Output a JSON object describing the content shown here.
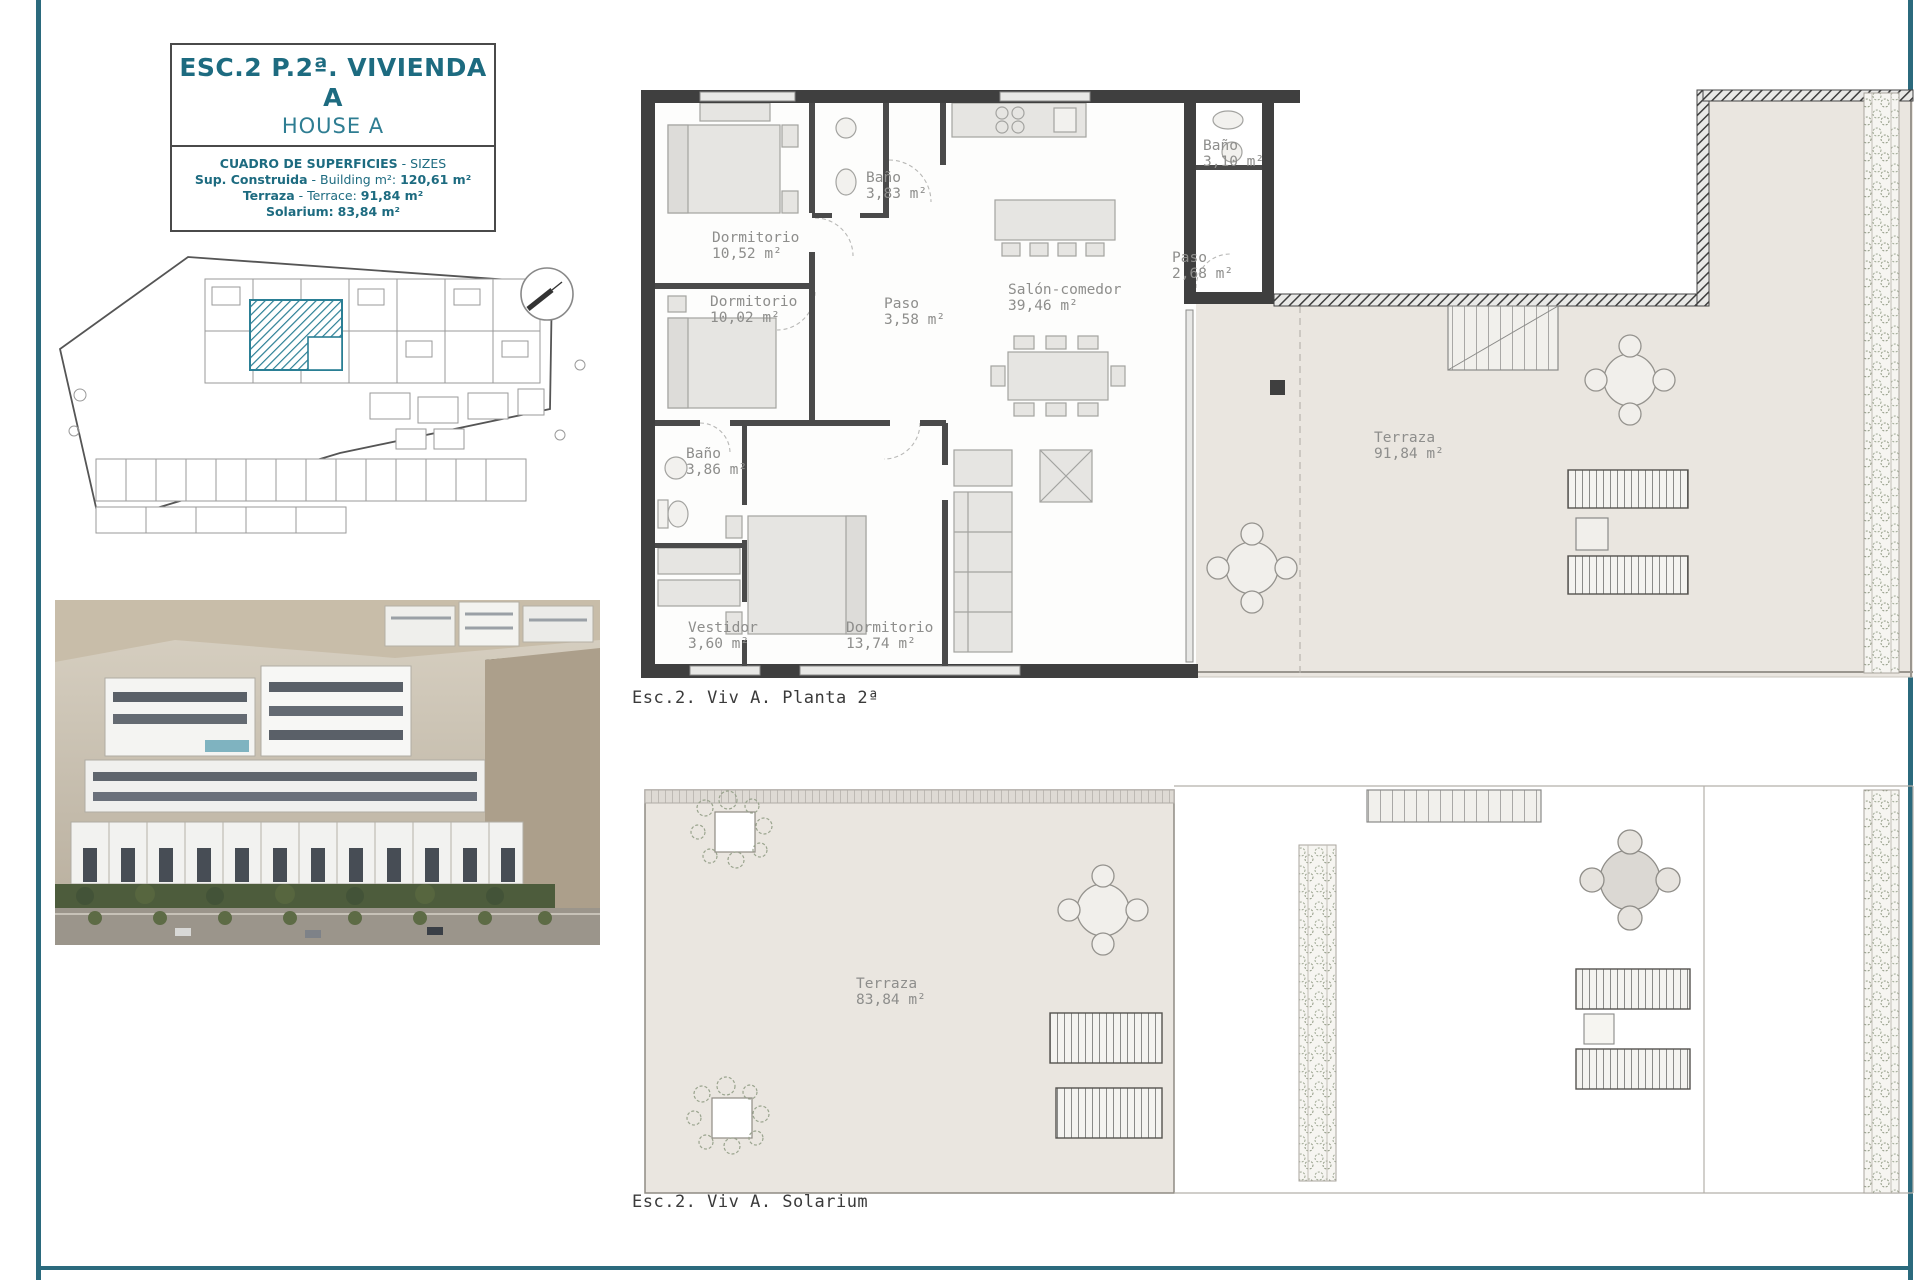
{
  "colors": {
    "accent": "#1d6b80",
    "accent_light": "#2e7d92",
    "teal_hatch": "#2a7f95",
    "terrace_beige": "#eae6e0"
  },
  "title_panel": {
    "title": "ESC.2 P.2ª. VIVIENDA A",
    "subtitle": "HOUSE A",
    "table_heading_bold": "CUADRO DE SUPERFICIES",
    "table_heading_rest": " - SIZES",
    "rows": [
      {
        "label": "Sup. Construida",
        "mid": " - Building m²: ",
        "value": "120,61 m²"
      },
      {
        "label": "Terraza",
        "mid": " - Terrace: ",
        "value": "91,84 m²"
      },
      {
        "label": "Solarium:",
        "mid": " ",
        "value": "83,84 m²"
      }
    ]
  },
  "floor_plan": {
    "caption": "Esc.2. Viv A. Planta 2ª",
    "rooms": [
      {
        "name": "Dormitorio",
        "area": "10,52 m²"
      },
      {
        "name": "Baño",
        "area": "3,83 m²"
      },
      {
        "name": "Dormitorio",
        "area": "10,02 m²"
      },
      {
        "name": "Paso",
        "area": "3,58 m²"
      },
      {
        "name": "Salón-comedor",
        "area": "39,46 m²"
      },
      {
        "name": "Baño",
        "area": "3,10 m²"
      },
      {
        "name": "Paso",
        "area": "2,68 m²"
      },
      {
        "name": "Baño",
        "area": "3,86 m²"
      },
      {
        "name": "Vestidor",
        "area": "3,60 m²"
      },
      {
        "name": "Dormitorio",
        "area": "13,74 m²"
      },
      {
        "name": "Terraza",
        "area": "91,84 m²"
      }
    ]
  },
  "solarium_plan": {
    "caption": "Esc.2. Viv A. Solarium",
    "rooms": [
      {
        "name": "Terraza",
        "area": "83,84 m²"
      }
    ]
  }
}
